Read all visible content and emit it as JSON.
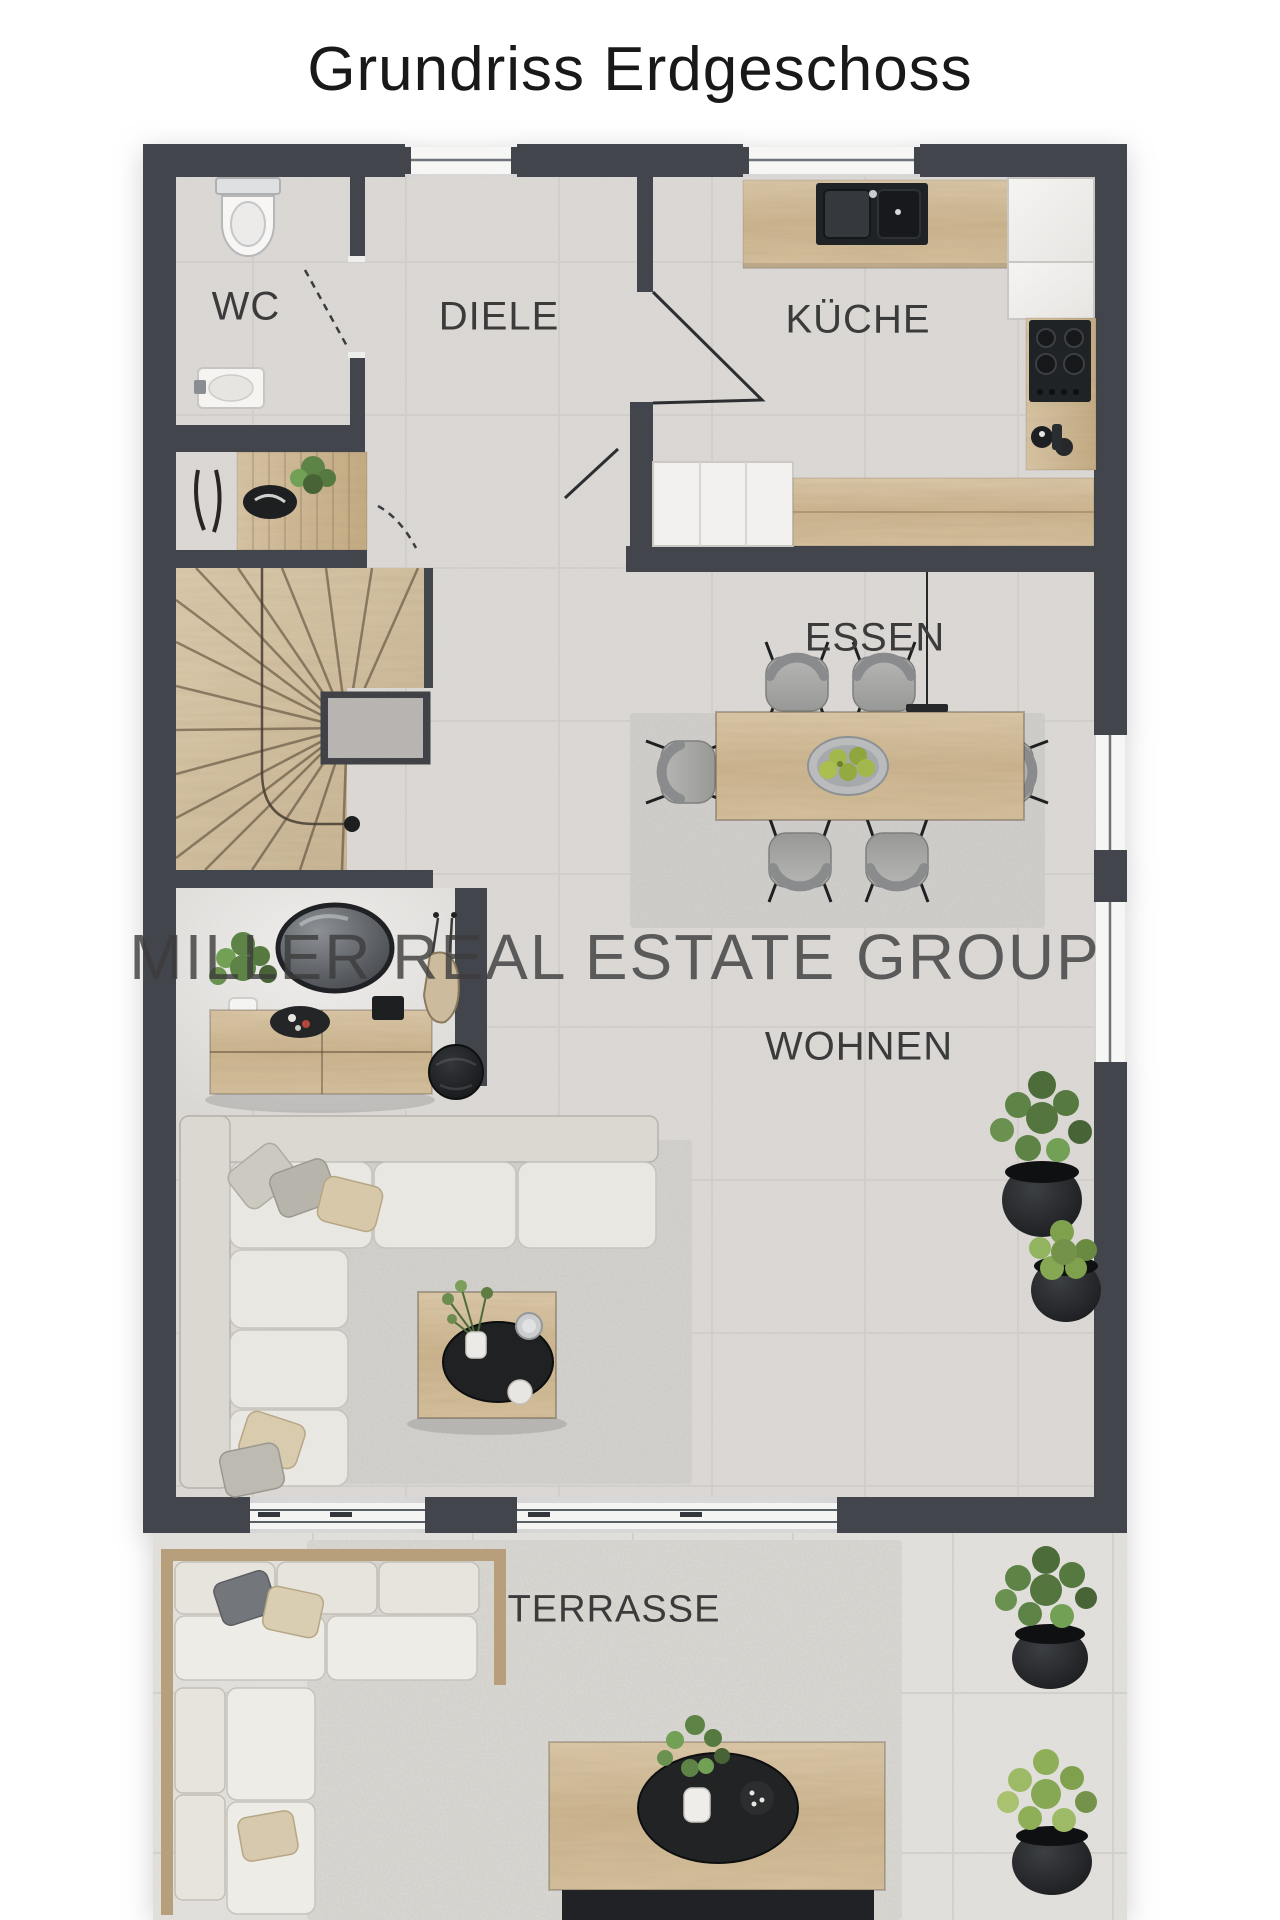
{
  "title": "Grundriss Erdgeschoss",
  "watermark": "MILLER REAL ESTATE GROUP",
  "rooms": [
    {
      "id": "wc",
      "label": "WC",
      "furniture": [
        "toilet",
        "washbasin"
      ]
    },
    {
      "id": "diele",
      "label": "DIELE",
      "furniture": [
        "entry-bench",
        "coat-hooks",
        "decor-bowl",
        "plant",
        "winder-staircase"
      ]
    },
    {
      "id": "kueche",
      "label": "KÜCHE",
      "furniture": [
        "kitchen-counter",
        "double-sink",
        "cooktop",
        "tall-cabinets",
        "island-counter"
      ]
    },
    {
      "id": "essen",
      "label": "ESSEN",
      "furniture": [
        "dining-table",
        "dining-chairs-x6",
        "fruit-bowl",
        "rug",
        "pendant-lamp"
      ]
    },
    {
      "id": "wohnen",
      "label": "WOHNEN",
      "furniture": [
        "corner-sofa",
        "coffee-table",
        "sideboard",
        "round-mirror",
        "pouf",
        "potted-plants-x2"
      ]
    },
    {
      "id": "terrasse",
      "label": "TERRASSE",
      "furniture": [
        "outdoor-corner-sofa",
        "outdoor-coffee-table",
        "outdoor-rug",
        "potted-plants-x2"
      ]
    }
  ],
  "colors": {
    "wall": "#42464c",
    "wood": "#d2bd9c",
    "floor": "#dcd9d5",
    "terrace_floor": "#e3e1dd",
    "rug": "#d3d1cd",
    "dark_fixture": "#202326",
    "plant_green": "#5d8446",
    "label_text": "#3b3b3b",
    "title_text": "#191919",
    "watermark_text": "#3c3c3c"
  }
}
